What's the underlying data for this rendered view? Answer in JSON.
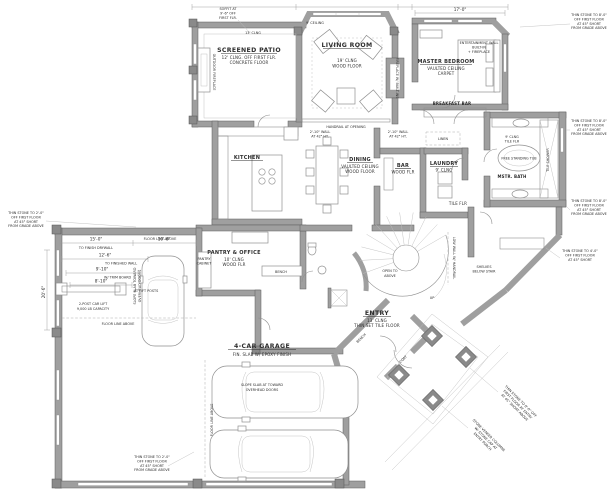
{
  "colors": {
    "background": "#ffffff",
    "wall": "#9f9f9f",
    "wall_outline": "#5f5f5f",
    "thin_line": "#8f8f8f",
    "text": "#2e2e2e"
  },
  "rooms": {
    "screened_patio": {
      "name": "SCREENED PATIO",
      "note1": "12' CLNG. OFF FIRST FLR.",
      "note2": "CONCRETE FLOOR"
    },
    "living_room": {
      "name": "LIVING ROOM",
      "note1": "19' CLNG",
      "note2": "WOOD FLOOR"
    },
    "master_bedroom": {
      "name": "MASTER BEDROOM",
      "note1": "VAULTED CEILING",
      "note2": "CARPET"
    },
    "breakfast_bar": {
      "name": "BREAKFAST BAR"
    },
    "kitchen": {
      "name": "KITCHEN"
    },
    "dining": {
      "name": "DINING",
      "note1": "VAULTED CEILING",
      "note2": "WOOD FLOOR"
    },
    "bar": {
      "name": "BAR",
      "note1": "WOOD FLR"
    },
    "laundry": {
      "name": "LAUNDRY",
      "note1": "9' CLNG",
      "note2": "TILE FLR"
    },
    "pantry_office": {
      "name": "PANTRY & OFFICE",
      "note1": "10' CLNG",
      "note2": "WOOD FLR"
    },
    "entry": {
      "name": "ENTRY",
      "note1": "13' CLNG",
      "note2": "THIN SET TILE FLOOR"
    },
    "garage": {
      "name": "4-CAR GARAGE",
      "note1": "FIN. SLAB W/ EPOXY FINISH"
    },
    "master_bath": {
      "name": "MSTR. BATH",
      "note1": "9' CLNG",
      "note2": "TILE FLR"
    }
  },
  "labels": {
    "clng13": "13' CLNG",
    "ceiling9": "9' CEILING",
    "outdoor_fireplace": "OUTDOOR FIREPLACE",
    "handrail": "HANDRAIL AT OPENING",
    "fireplace_builtins": "FIREPLACE W/ BUILT-INS",
    "knee1": "2'-10\" WALL",
    "knee2": "AT 42\" HT.",
    "free_tub": "FREE STANDING TUB",
    "tile_shower": "TILE SHOWER",
    "linen": "LINEN",
    "open1": "OPEN TO",
    "open2": "ABOVE",
    "up": "UP",
    "low_wall": "LOW WALL W/ HANDRAIL",
    "bench": "BENCH",
    "coat": "COAT",
    "floor_line": "FLOOR LINE ABOVE",
    "slope_v1": "SLOPE SLAB TOWARD",
    "slope_v2": "OVERHEAD DOORS",
    "slope_c1": "SLOPE SLAB AT TOWARD",
    "slope_c2": "OVERHEAD DOORS",
    "lift1": "2-POST CAR LIFT",
    "lift2": "9,000 LB CAPACITY"
  },
  "dims": {
    "d1": "15'-0\"",
    "d1s": "TO FINISH DRYWALL",
    "d2": "10'-6\"",
    "d3": "12'-6\"",
    "d3s": "TO FINISHED WALL",
    "d4": "9'-10\"",
    "d4s": "W/ TRIM BOARD",
    "d5": "8'-10\"",
    "d5s": "AT LIFT POSTS",
    "d6": "20'-6\"",
    "d7": "17'-0\""
  },
  "annotations": {
    "soffit": [
      "SOFFIT AT",
      "9'-6\" OFF",
      "FIRST FLR."
    ],
    "entertainment": [
      "ENTERTAINMENT WALL",
      "BUILT-IN",
      "+ FIREPLACE"
    ],
    "shelves": [
      "SHELVES",
      "BELOW STAIR"
    ],
    "pantry_cabinet": [
      "PANTRY",
      "CABINET"
    ],
    "left": [
      "THIN STONE TO 2'-0\"",
      "OFF FIRST FLOOR",
      "AT 45° SHORT",
      "FROM GRADE ABOVE"
    ],
    "bottom_left": [
      "THIN STONE TO 2'-0\"",
      "OFF FIRST FLOOR",
      "AT 45° SHORT",
      "FROM GRADE ABOVE"
    ],
    "right_top": [
      "THIN STONE TO 8'-0\"",
      "OFF FIRST FLOOR",
      "AT 45° SHORT",
      "FROM GRADE ABOVE"
    ],
    "right_mid": [
      "THIN STONE TO 8'-0\"",
      "OFF FIRST FLOOR",
      "AT 45° SHORT",
      "FROM GRADE ABOVE"
    ],
    "right_low": [
      "THIN STONE TO 8'-0\"",
      "OFF FIRST FLOOR",
      "AT 45° SHORT",
      "FROM GRADE ABOVE"
    ],
    "wing": [
      "THIN STONE TO 4'-0\"",
      "OFF FIRST FLOOR",
      "AT 45° SHORT"
    ],
    "porch_a": [
      "THIN STONE TO 8'-0\" OFF",
      "FIRST FLOOR AT ENTRY",
      "AT 45° SHORT ABOVE"
    ],
    "porch_b": [
      "STONE VENEER COLUMNS",
      "W/ STONE CAP AT",
      "ENTRY PORCH"
    ]
  }
}
